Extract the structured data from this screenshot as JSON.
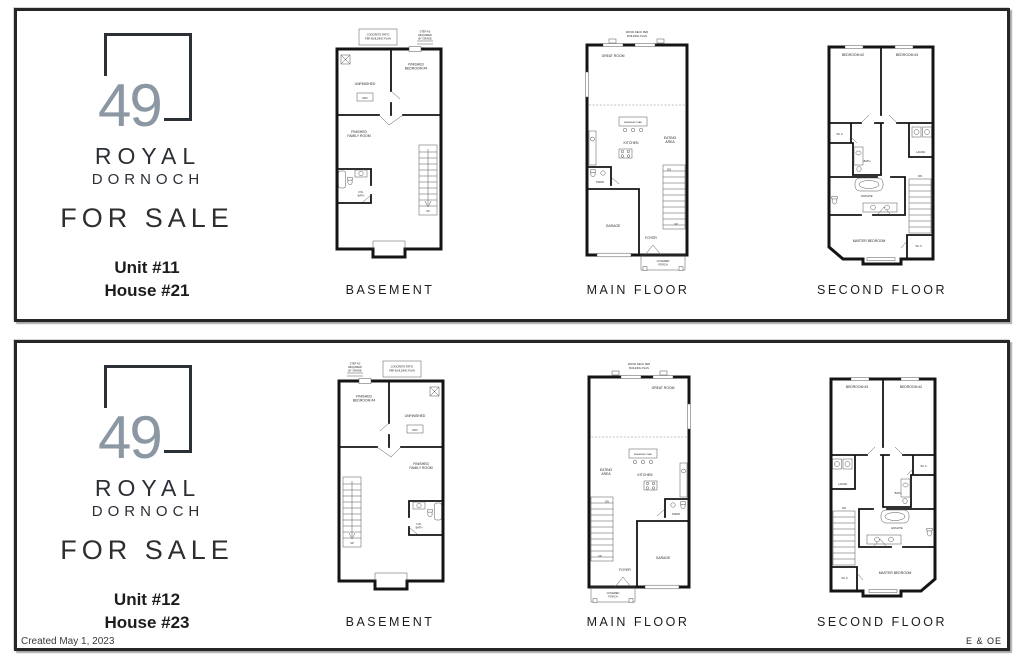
{
  "logo": {
    "number": "49",
    "royal": "ROYAL",
    "dornoch": "DORNOCH"
  },
  "for_sale": "FOR SALE",
  "panels": [
    {
      "unit": "Unit #11",
      "house": "House #21"
    },
    {
      "unit": "Unit #12",
      "house": "House #23"
    }
  ],
  "labels": {
    "basement": {
      "caption": "BASEMENT",
      "patio1": "CONCRETE PATIO",
      "patio2": "PER BUILDING PLAN",
      "step1": "STEP AS",
      "step2": "REQUIRED",
      "step3": "BY GRADE",
      "unfinished": "UNFINISHED",
      "hrv": "HRV",
      "bed4a": "FINISHED",
      "bed4b": "BEDROOM #4",
      "fama": "FINISHED",
      "famb": "FAMILY ROOM",
      "batha": "FIN.",
      "bathb": "BATH",
      "up": "UP"
    },
    "main": {
      "caption": "MAIN FLOOR",
      "deck1": "WOOD DECK PER",
      "deck2": "BUILDING PLAN",
      "great": "GREAT ROOM",
      "bar": "BREAKFAST BAR",
      "kitchen": "KITCHEN",
      "eat1": "EATING",
      "eat2": "AREA",
      "pwdr": "PWDR",
      "foyer": "FOYER",
      "garage": "GARAGE",
      "porch1": "COVERED",
      "porch2": "PORCH",
      "dn": "DN",
      "up": "UP"
    },
    "second": {
      "caption": "SECOND FLOOR",
      "bed2": "BEDROOM #2",
      "bed3": "BEDROOM #3",
      "wic": "W.I.C.",
      "bath": "BATH",
      "laund": "LAUND.",
      "ensuite": "ENSUITE",
      "master": "MASTER BEDROOM",
      "wic2": "W.I.C.",
      "dn": "DN"
    }
  },
  "footer": {
    "created": "Created May 1, 2023",
    "eoe": "E & OE"
  }
}
